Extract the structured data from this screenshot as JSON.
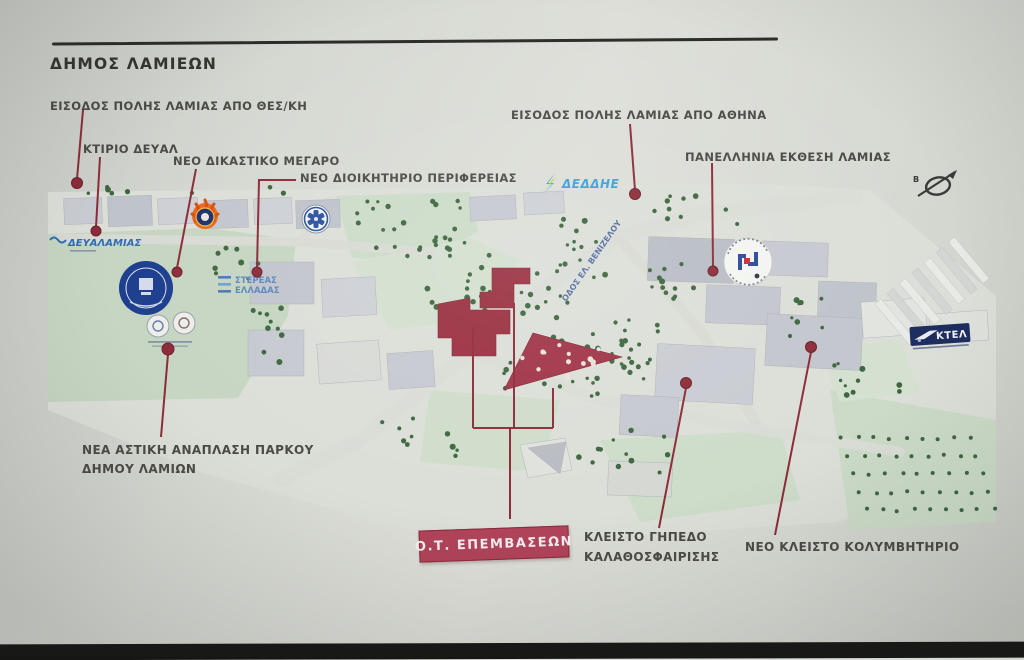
{
  "title": "ΔΗΜΟΣ ΛΑΜΙΕΩΝ",
  "callouts": {
    "entry_thessaloniki": "ΕΙΣΟΔΟΣ ΠΟΛΗΣ ΛΑΜΙΑΣ ΑΠΟ ΘΕΣ/ΚΗ",
    "ktirio_deyal": "ΚΤΙΡΙΟ ΔΕΥΑΛ",
    "new_courthouse": "ΝΕΟ ΔΙΚΑΣΤΙΚΟ ΜΕΓΑΡΟ",
    "new_region_hq": "ΝΕΟ ΔΙΟΙΚΗΤΗΡΙΟ ΠΕΡΙΦΕΡΕΙΑΣ",
    "entry_athens": "ΕΙΣΟΔΟΣ ΠΟΛΗΣ ΛΑΜΙΑΣ ΑΠΟ ΑΘΗΝΑ",
    "expo": "ΠΑΝΕΛΛΗΝΙΑ ΕΚΘΕΣΗ ΛΑΜΙΑΣ",
    "park_redev_line1": "ΝΕΑ ΑΣΤΙΚΗ ΑΝΑΠΛΑΣΗ ΠΑΡΚΟΥ",
    "park_redev_line2": "ΔΗΜΟΥ ΛΑΜΙΩΝ",
    "ot_interventions": "Ο.Τ. ΕΠΕΜΒΑΣΕΩΝ",
    "basketball_line1": "ΚΛΕΙΣΤΟ ΓΗΠΕΔΟ",
    "basketball_line2": "ΚΑΛΑΘΟΣΦΑΙΡΙΣΗΣ",
    "pool": "ΝΕΟ ΚΛΕΙΣΤΟ ΚΟΛΥΜΒΗΤΗΡΙΟ"
  },
  "map": {
    "deddie_logo": "ΔΕΔΔΗΕ",
    "deyal_logo": "ΔΕΥΑΛΑΜΙΑΣ",
    "region_logo_line1": "ΣΤΕΡΕΑΣ",
    "region_logo_line2": "ΕΛΛΑΔΑΣ",
    "ktel_logo": "ΚΤΕΛ",
    "street_name": "ΟΔΟΣ ΕΛ. ΒΕΝΙΖΕΛΟΥ",
    "north_letter": "Β"
  },
  "colors": {
    "callout_accent": "#8c2c38",
    "intervention_fill": "#9a2f40",
    "ot_box_fill": "#b0435a",
    "label_text": "#4b4a45",
    "park_green": "#c6d6c2",
    "tree_green": "#3d663e",
    "building_gray": "#b6bac2",
    "bottom_bar": "#161614"
  }
}
